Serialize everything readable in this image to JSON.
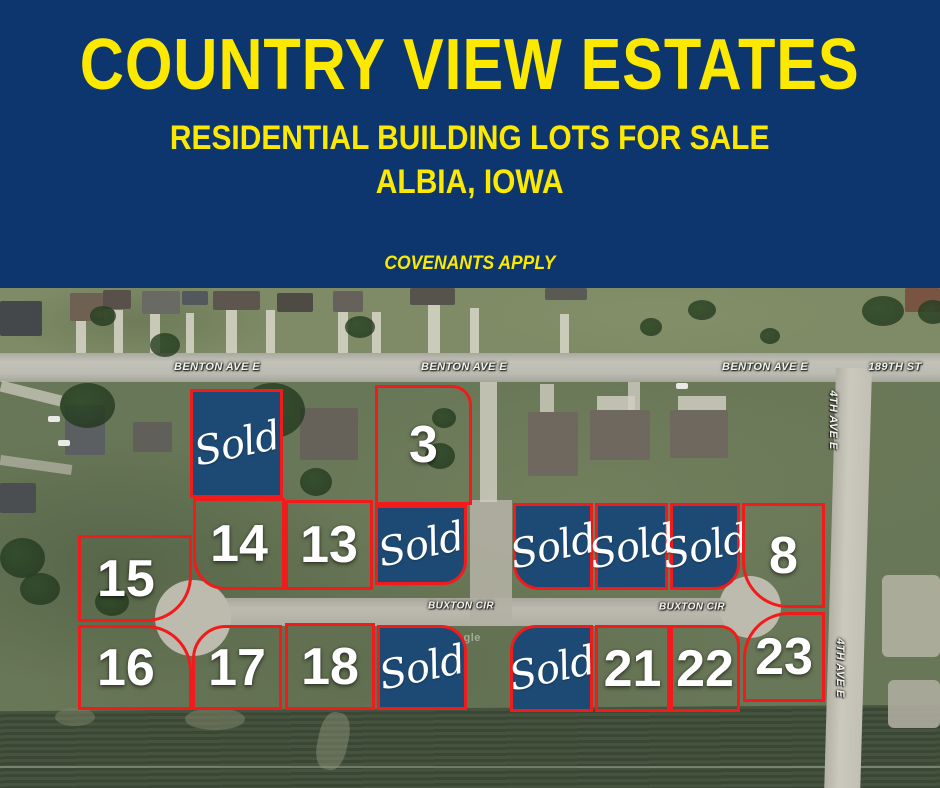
{
  "header": {
    "title": "COUNTRY VIEW ESTATES",
    "subtitle": "RESIDENTIAL BUILDING LOTS FOR SALE",
    "location": "ALBIA, IOWA",
    "note": "COVENANTS APPLY"
  },
  "colors": {
    "header_bg": "#0d366e",
    "accent_yellow": "#fde900",
    "lot_border_red": "#f11b1b",
    "sold_box_blue": "#1d4a74"
  },
  "map": {
    "watermark": "Google",
    "streets": [
      {
        "name": "BENTON AVE E"
      },
      {
        "name": "BENTON AVE E"
      },
      {
        "name": "BENTON AVE E"
      },
      {
        "name": "189TH ST"
      },
      {
        "name": "4TH AVE E"
      },
      {
        "name": "4TH AVE E"
      },
      {
        "name": "BUXTON CIR"
      },
      {
        "name": "BUXTON CIR"
      }
    ],
    "lots": [
      {
        "label": "Sold",
        "status": "sold"
      },
      {
        "label": "3",
        "status": "available"
      },
      {
        "label": "14",
        "status": "available"
      },
      {
        "label": "13",
        "status": "available"
      },
      {
        "label": "Sold",
        "status": "sold"
      },
      {
        "label": "15",
        "status": "available"
      },
      {
        "label": "16",
        "status": "available"
      },
      {
        "label": "17",
        "status": "available"
      },
      {
        "label": "18",
        "status": "available"
      },
      {
        "label": "Sold",
        "status": "sold"
      },
      {
        "label": "Sold",
        "status": "sold"
      },
      {
        "label": "Sold",
        "status": "sold"
      },
      {
        "label": "Sold",
        "status": "sold"
      },
      {
        "label": "8",
        "status": "available"
      },
      {
        "label": "Sold",
        "status": "sold"
      },
      {
        "label": "21",
        "status": "available"
      },
      {
        "label": "22",
        "status": "available"
      },
      {
        "label": "23",
        "status": "available"
      }
    ]
  }
}
